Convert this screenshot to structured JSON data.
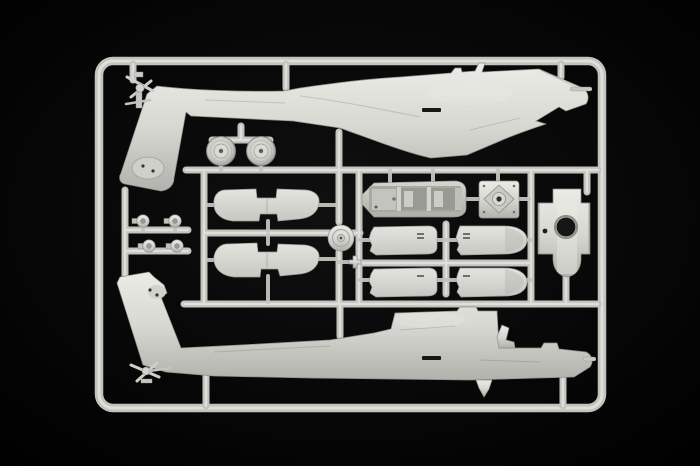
{
  "scene": {
    "subject": "injection-molded model kit sprue of an attack helicopter (two fuselage halves and detail parts) photographed on a black background",
    "material": "light grey styrene plastic",
    "orientation": "both fuselage halves lie horizontally, tails to the left, noses to the right"
  },
  "colors": {
    "background": "#060606",
    "plastic_base": "#d6d6d0",
    "plastic_highlight": "#ebebe5",
    "plastic_shadow": "#b0b0aa",
    "runner_base": "#c3c3be",
    "runner_highlight": "#dfdfd9",
    "edge_line": "#8f8f8a",
    "hole_dark": "#161616"
  },
  "parts": [
    {
      "id": "sprue-frame",
      "desc": "rounded rectangular runner frame with internal runner rails"
    },
    {
      "id": "fuselage-half-upper",
      "desc": "fuselage half, tail rotor and down-swept tail fin at left, sensor nose at right"
    },
    {
      "id": "fuselage-half-lower",
      "desc": "opposite fuselage half, tail fin sweeping up at left, nose at right"
    },
    {
      "id": "main-wheel-left",
      "desc": "round landing-gear wheel with hub"
    },
    {
      "id": "main-wheel-right",
      "desc": "round landing-gear wheel with hub"
    },
    {
      "id": "small-hub-parts",
      "desc": "four small round hub/cylinder parts on a ladder runner"
    },
    {
      "id": "stabilator-upper",
      "desc": "flat horizontal stabilator panel with center notches"
    },
    {
      "id": "stabilator-lower",
      "desc": "flat horizontal stabilator panel with center notches"
    },
    {
      "id": "rotor-hub-disc",
      "desc": "circular disc with concentric ring detail"
    },
    {
      "id": "cross-part",
      "desc": "small plus-shaped part"
    },
    {
      "id": "cockpit-tub",
      "desc": "long cockpit interior tray with two crew wells"
    },
    {
      "id": "gearbox-plate",
      "desc": "square transmission plate with diamond face and round boss"
    },
    {
      "id": "engine-panel-1",
      "desc": "rectangular engine cowling panel"
    },
    {
      "id": "engine-panel-2",
      "desc": "rectangular engine cowling panel"
    },
    {
      "id": "engine-panel-3",
      "desc": "rectangular engine cowling panel"
    },
    {
      "id": "engine-panel-4",
      "desc": "rectangular engine cowling panel"
    },
    {
      "id": "engine-nacelle",
      "desc": "vertical nacelle part with ribbed flanges, round opening and flared skirt"
    }
  ]
}
